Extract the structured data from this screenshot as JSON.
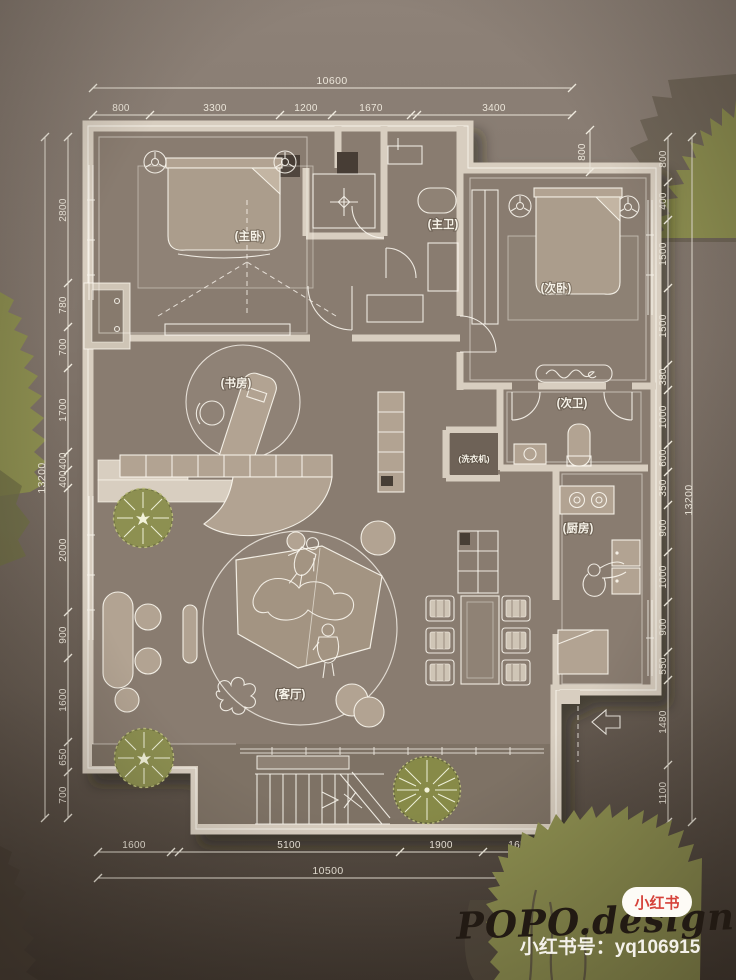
{
  "dimensions": {
    "top": {
      "total": "10600",
      "segments": [
        "800",
        "3300",
        "1200",
        "1670",
        "3400"
      ]
    },
    "left": {
      "total": "13200",
      "segments": [
        "2800",
        "780",
        "700",
        "1700",
        "400",
        "400",
        "2000",
        "900",
        "1600",
        "650",
        "700"
      ]
    },
    "right": {
      "total": "13200",
      "segments": [
        "800",
        "400",
        "1500",
        "1500",
        "380",
        "1000",
        "600",
        "350",
        "900",
        "1000",
        "900",
        "550",
        "1480",
        "1100"
      ]
    },
    "bottom": {
      "total": "10500",
      "segments": [
        "1600",
        "5100",
        "1900",
        "1650"
      ]
    },
    "offset": "800"
  },
  "rooms": {
    "master_bedroom": "(主卧)",
    "master_bath": "(主卫)",
    "second_bedroom": "(次卧)",
    "second_bath": "(次卫)",
    "study": "(书房)",
    "kitchen": "(厨房)",
    "living_room": "(客厅)",
    "washer": "(洗衣机)"
  },
  "watermark": {
    "brand": "POPO.design",
    "account_label": "小红书号：yq106915",
    "badge": "小红书"
  },
  "colors": {
    "wall": "#d8cec0",
    "floor": "#897c6f",
    "furniture": "#b2a392",
    "tree": "#8d9051",
    "badge_red": "#d6423a",
    "dim_text": "#ece6da"
  }
}
